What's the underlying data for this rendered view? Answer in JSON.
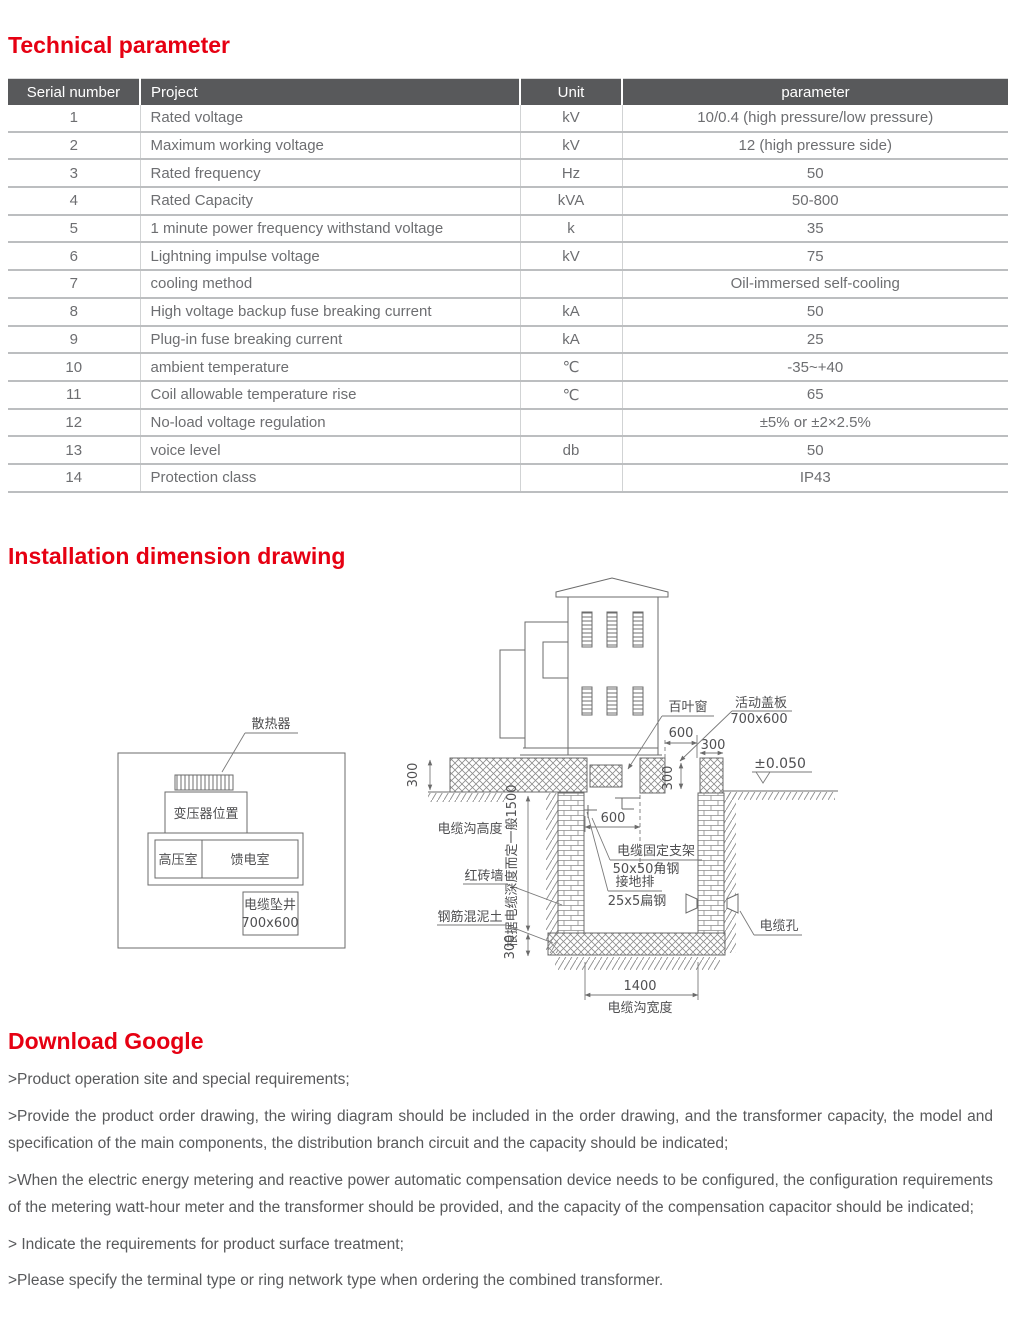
{
  "sections": {
    "technical_title": "Technical parameter",
    "installation_title": "Installation dimension drawing",
    "download_title": "Download Google"
  },
  "table": {
    "headers": [
      "Serial number",
      "Project",
      "Unit",
      "parameter"
    ],
    "rows": [
      [
        "1",
        "Rated voltage",
        "kV",
        "10/0.4 (high pressure/low pressure)"
      ],
      [
        "2",
        "Maximum working voltage",
        "kV",
        "12 (high pressure side)"
      ],
      [
        "3",
        "Rated frequency",
        "Hz",
        "50"
      ],
      [
        "4",
        "Rated Capacity",
        "kVA",
        "50-800"
      ],
      [
        "5",
        "1 minute power frequency withstand voltage",
        "k",
        "35"
      ],
      [
        "6",
        "Lightning impulse voltage",
        "kV",
        "75"
      ],
      [
        "7",
        "cooling method",
        "",
        "Oil-immersed self-cooling"
      ],
      [
        "8",
        "High voltage backup fuse breaking current",
        "kA",
        "50"
      ],
      [
        "9",
        "Plug-in fuse breaking current",
        "kA",
        "25"
      ],
      [
        "10",
        "ambient temperature",
        "℃",
        "-35~+40"
      ],
      [
        "11",
        "Coil allowable temperature rise",
        "℃",
        "65"
      ],
      [
        "12",
        "No-load voltage regulation",
        "",
        "±5% or ±2×2.5%"
      ],
      [
        "13",
        "voice level",
        "db",
        "50"
      ],
      [
        "14",
        "Protection class",
        "",
        "IP43"
      ]
    ]
  },
  "drawing": {
    "radiator": "散热器",
    "transformer_position": "变压器位置",
    "hv_room": "高压室",
    "feeder_room": "馈电室",
    "cable_well": "电缆坠井",
    "cable_well_size": "700x600",
    "louver": "百叶窗",
    "cover_plate": "活动盖板",
    "cover_plate_size": "700x600",
    "dim_600_top": "600",
    "dim_300_right": "300",
    "dim_300_slab": "300",
    "dim_300_opening": "300",
    "level_mark": "±0.050",
    "trench_height": "电缆沟高度",
    "depth_note": "根据电缆深度而定一般1500",
    "red_brick_wall": "红砖墙",
    "reinforced_concrete": "钢筋混泥土",
    "dim_300_floor": "300",
    "dim_600_pit": "600",
    "cable_bracket": "电缆固定支架",
    "cable_bracket_spec": "50x50角钢",
    "ground_bar": "接地排",
    "ground_bar_spec": "25x5扁钢",
    "cable_hole": "电缆孔",
    "dim_1400": "1400",
    "trench_width": "电缆沟宽度"
  },
  "paragraphs": [
    ">Product operation site and special requirements;",
    ">Provide the product order drawing, the wiring diagram should be included in the order drawing, and the transformer capacity, the model and specification of the main components, the distribution branch circuit and the capacity should be indicated;",
    ">When the electric energy metering and reactive power automatic compensation device needs to be configured, the configuration requirements of the metering watt-hour meter and the transformer should be provided, and the capacity of the compensation capacitor should be indicated;",
    "> Indicate the requirements for product surface treatment;",
    ">Please specify the terminal type or ring network type when ordering the combined transformer."
  ],
  "colors": {
    "heading_red": "#e60012",
    "table_header_bg": "#58595b",
    "body_text": "#58595b",
    "table_text": "#6d6e71"
  }
}
